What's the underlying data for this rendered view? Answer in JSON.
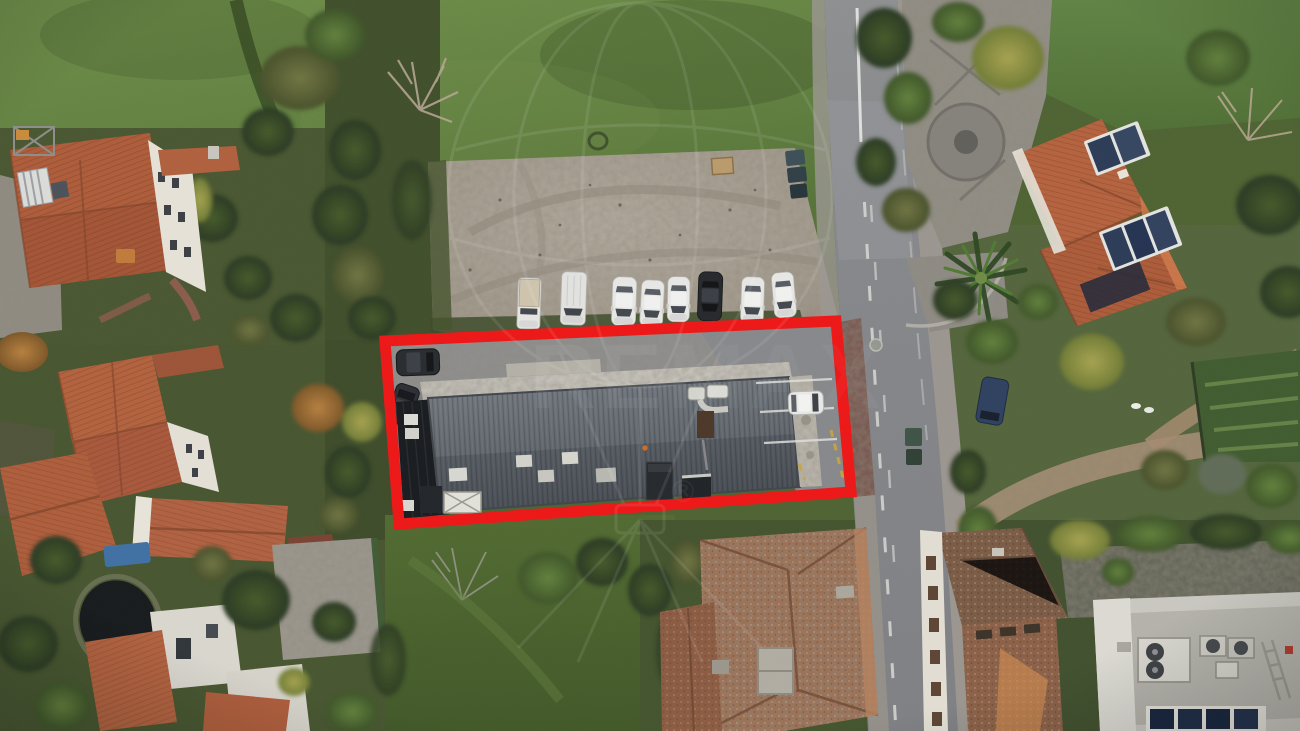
{
  "image": {
    "kind": "aerial drone photograph",
    "subject": "Top-down drone photo of a long grey-roofed building and its yard outlined with a thick red property boundary, beside a two-lane road, a gravel car park with a row of parked vehicles, terracotta-roofed houses, gardens and green fields",
    "boundary": {
      "shape": "rotated rectangle",
      "color": "#ee1414"
    },
    "watermark": {
      "name": "remax-balloon-watermark",
      "letters_left": "RE",
      "letters_right": "MAX",
      "registered_symbol": "®"
    },
    "counts": {
      "vehicles_in_gravel_row": 8,
      "dark_cars_inside_boundary": 2,
      "white_cars_inside_boundary": 1
    },
    "road": {
      "lanes": 2,
      "marking": "worn white centre line with dashes"
    }
  },
  "palette": {
    "boundary_red": "#ee1414",
    "field_green": "#64833f",
    "gravel": "#a8a095",
    "asphalt": "#87888b",
    "terracotta_roof": "#b05f3b",
    "metal_roof_grey": "#636970",
    "solar_panel_blue": "#2a3a55",
    "pond_dark": "#14181a"
  }
}
